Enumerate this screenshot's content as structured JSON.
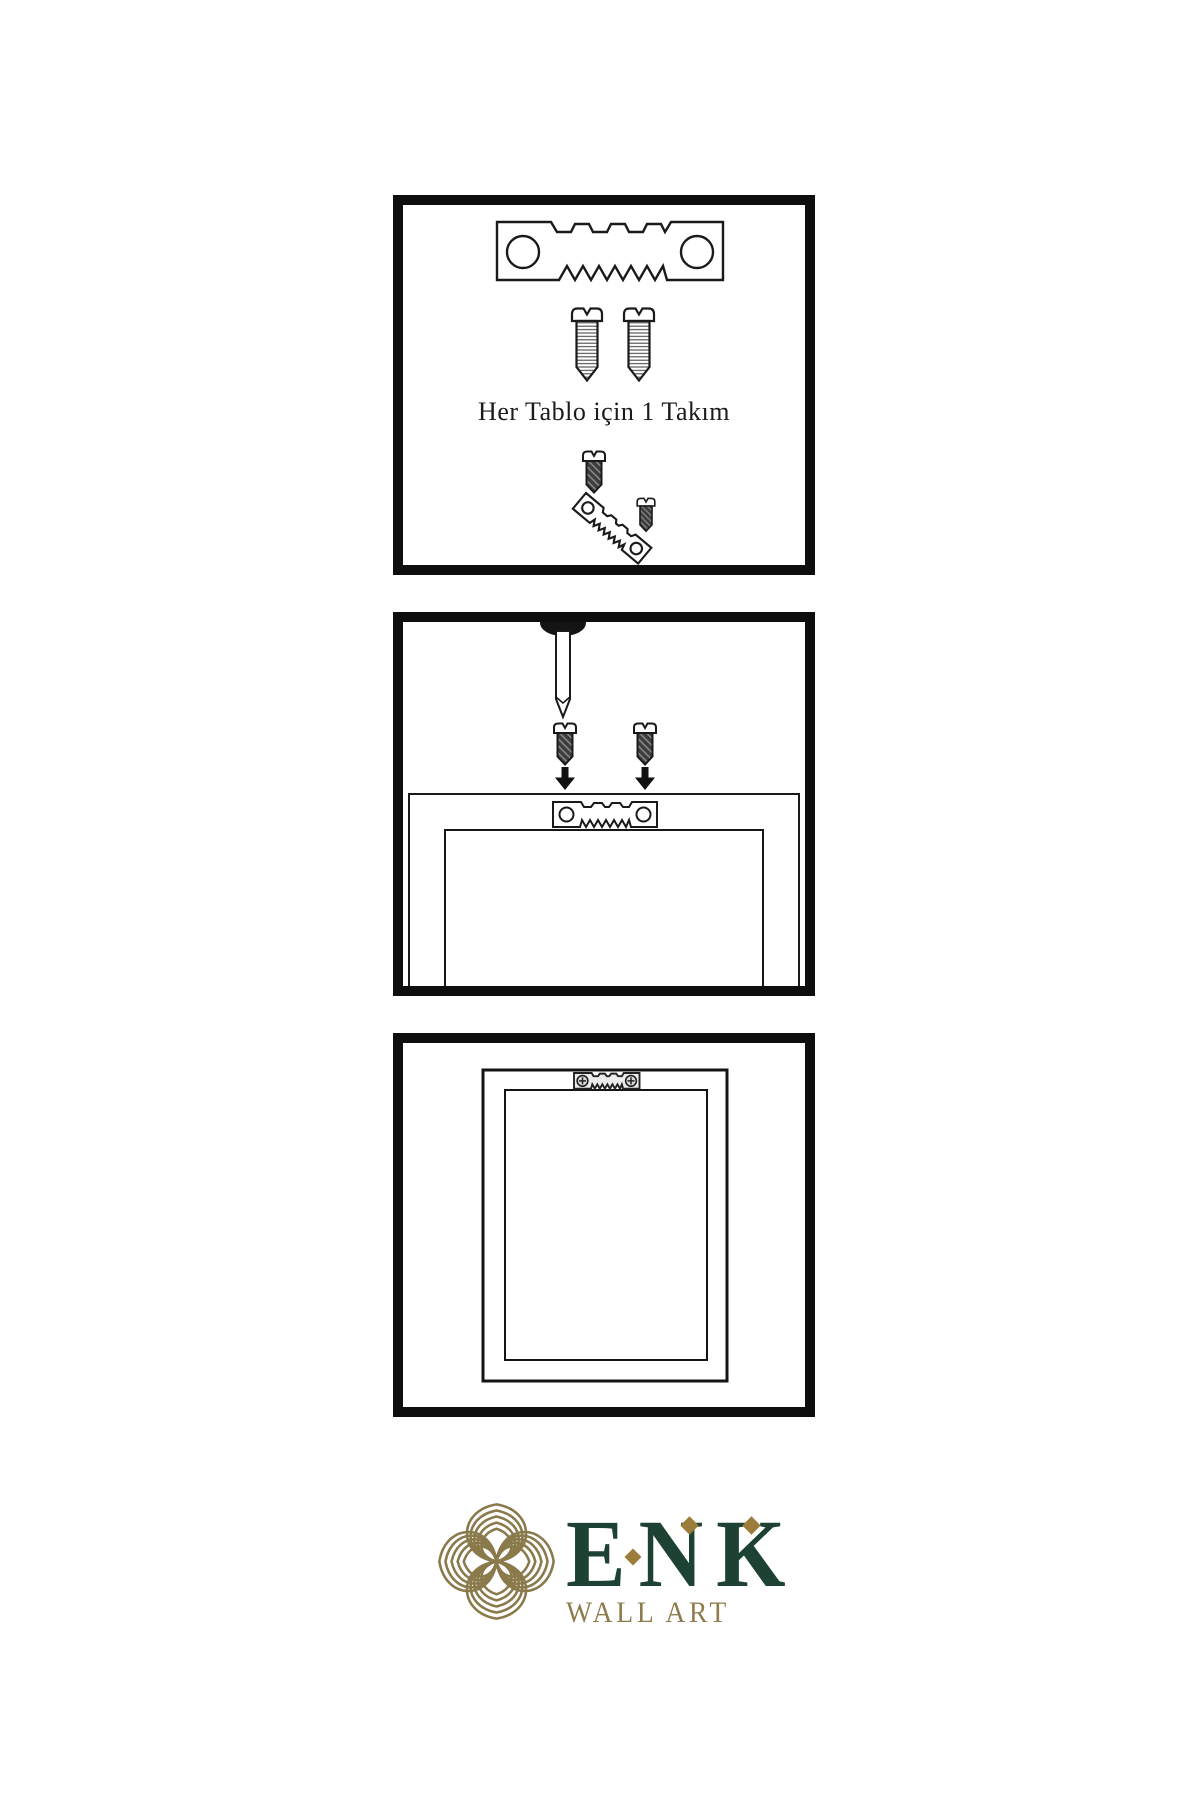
{
  "panel1": {
    "caption": "Her Tablo için 1 Takım",
    "items": [
      "sawtooth-hanger",
      "screw",
      "screw",
      "screw-into-hanger-assembly"
    ]
  },
  "panel2": {
    "items": [
      "wall-nail",
      "screw",
      "screw",
      "down-arrow",
      "down-arrow",
      "frame-back-with-sawtooth-hanger"
    ]
  },
  "panel3": {
    "items": [
      "hung-frame-with-sawtooth-hanger"
    ]
  },
  "logo": {
    "brand": "ENK",
    "subtitle": "WALL ART",
    "colors": {
      "brand_green": "#1d4233",
      "brand_gold": "#8a7a4b",
      "accent_gold": "#9c7c3b"
    }
  }
}
